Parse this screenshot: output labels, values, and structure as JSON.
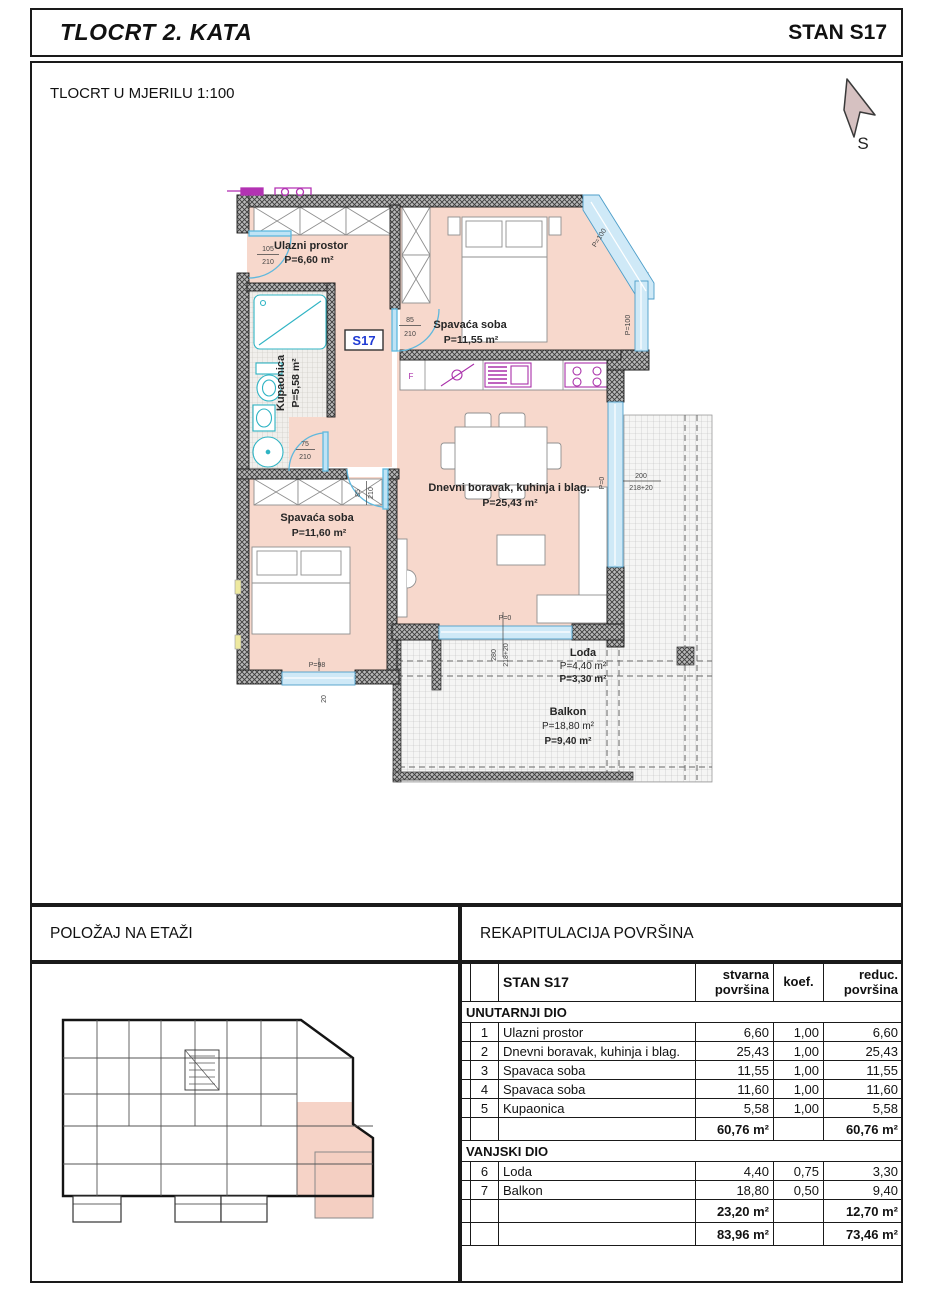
{
  "title_bar": {
    "left": "TLOCRT 2. KATA",
    "right": "STAN S17"
  },
  "drawing": {
    "scale_note": "TLOCRT U MJERILU 1:100",
    "north_label": "S",
    "unit_tag": "S17",
    "rooms": {
      "entrance": {
        "name": "Ulazni prostor",
        "area": "P=6,60 m²"
      },
      "bedroom_top": {
        "name": "Spavaća soba",
        "area": "P=11,55 m²"
      },
      "bathroom": {
        "name": "Kupaonica",
        "area": "P=5,58 m²"
      },
      "bedroom_bottom": {
        "name": "Spavaća soba",
        "area": "P=11,60 m²"
      },
      "living": {
        "name": "Dnevni boravak, kuhinja i blag.",
        "area": "P=25,43 m²"
      },
      "loggia": {
        "name": "Lođa",
        "area": "P=4,40 m²",
        "area_reduced": "P=3,30 m²"
      },
      "balcony": {
        "name": "Balkon",
        "area": "P=18,80 m²",
        "area_reduced": "P=9,40 m²"
      }
    },
    "dims": {
      "entrance_door_w": "105",
      "entrance_door_h": "210",
      "bedroom_top_door_w": "85",
      "bedroom_top_door_h": "210",
      "bathroom_door_w": "75",
      "bathroom_door_h": "210",
      "bedroom_bottom_door_w": "85",
      "bedroom_bottom_door_h": "210",
      "diag_window_1": "P=100",
      "diag_window_2": "P=100",
      "right_window_sill": "P=0",
      "right_window_w": "200",
      "right_window_h": "218+20",
      "loggia_window_sill": "P=0",
      "loggia_window_w": "280",
      "loggia_window_h": "218+20",
      "bedroom_window_sill": "P=98",
      "bedroom_window_note": "20",
      "kitchen_fridge": "F"
    }
  },
  "key_plan": {
    "title": "POLOŽAJ NA ETAŽI"
  },
  "recap": {
    "title": "REKAPITULACIJA POVRŠINA",
    "header": {
      "name": "STAN S17",
      "actual": "stvarna površina",
      "coef": "koef.",
      "reduced": "reduc. površina"
    },
    "section_inner": "UNUTARNJI DIO",
    "section_outer": "VANJSKI DIO",
    "rows_inner": [
      {
        "num": "1",
        "name": "Ulazni prostor",
        "actual": "6,60",
        "coef": "1,00",
        "reduced": "6,60"
      },
      {
        "num": "2",
        "name": "Dnevni boravak, kuhinja i blag.",
        "actual": "25,43",
        "coef": "1,00",
        "reduced": "25,43"
      },
      {
        "num": "3",
        "name": "Spavaca soba",
        "actual": "11,55",
        "coef": "1,00",
        "reduced": "11,55"
      },
      {
        "num": "4",
        "name": "Spavaca soba",
        "actual": "11,60",
        "coef": "1,00",
        "reduced": "11,60"
      },
      {
        "num": "5",
        "name": "Kupaonica",
        "actual": "5,58",
        "coef": "1,00",
        "reduced": "5,58"
      }
    ],
    "subtotal_inner": {
      "actual": "60,76 m²",
      "reduced": "60,76 m²"
    },
    "rows_outer": [
      {
        "num": "6",
        "name": "Loda",
        "actual": "4,40",
        "coef": "0,75",
        "reduced": "3,30"
      },
      {
        "num": "7",
        "name": "Balkon",
        "actual": "18,80",
        "coef": "0,50",
        "reduced": "9,40"
      }
    ],
    "subtotal_outer": {
      "actual": "23,20 m²",
      "reduced": "12,70 m²"
    },
    "total": {
      "actual": "83,96 m²",
      "reduced": "73,46 m²"
    }
  },
  "colors": {
    "floor_pink": "#f7d8cc",
    "window_blue": "#cfe9f7",
    "fixture_cyan": "#2fb4c4",
    "kitchen_magenta": "#aa30aa",
    "accent_blue": "#1f3bd4",
    "wall_gray": "#8f8f8f"
  }
}
